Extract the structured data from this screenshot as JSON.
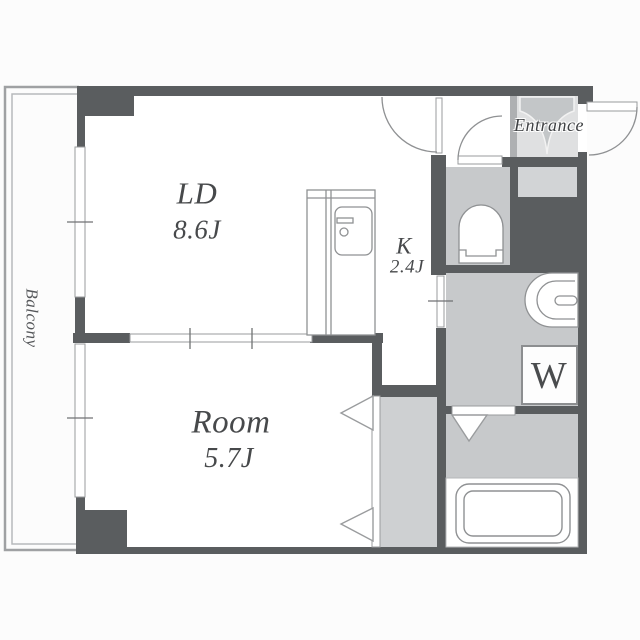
{
  "plan": {
    "type": "apartment-floor-plan",
    "labels": {
      "balcony": "Balcony",
      "entrance": "Entrance",
      "washer": "W"
    },
    "rooms": [
      {
        "id": "living-dining",
        "name": "LD",
        "area": "8.6J"
      },
      {
        "id": "bedroom",
        "name": "Room",
        "area": "5.7J"
      },
      {
        "id": "kitchen",
        "name": "K",
        "area": "2.4J"
      }
    ],
    "colors": {
      "wall": "#5a5d5f",
      "room_floor": "#ffffff",
      "wet_area_floor": "#c7c9cb",
      "closet_floor": "#ced0d2",
      "genkan_floor": "#dfe0e1",
      "shoe_box": "#d2d4d6",
      "fixture_line": "#8f9193",
      "text": "#47494b",
      "background": "#fcfcfc"
    }
  }
}
